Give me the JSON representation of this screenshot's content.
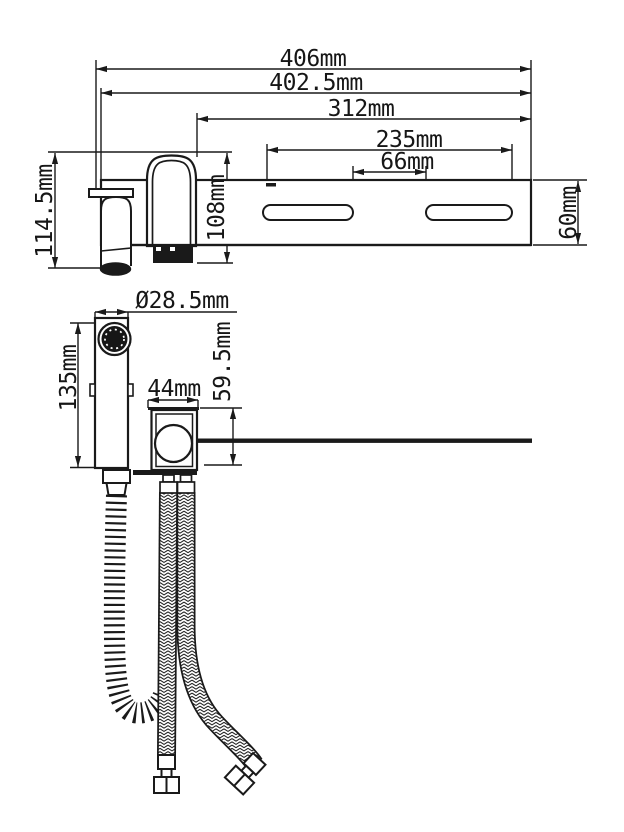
{
  "drawing": {
    "type": "technical-dimension-drawing",
    "subject": "wall-mounted faucet with shelf, hand sprayer and supply hoses",
    "colors": {
      "background": "#ffffff",
      "line": "#1a1a1a"
    }
  },
  "dimensions": {
    "overall_width": "406mm",
    "plate_width": "402.5mm",
    "body_to_end": "312mm",
    "slots_span": "235mm",
    "slots_gap": "66mm",
    "left_height": "114.5mm",
    "handle_height": "108mm",
    "shelf_depth": "60mm",
    "sprayer_diameter": "Ø28.5mm",
    "sprayer_length": "135mm",
    "valve_width": "44mm",
    "valve_height": "59.5mm"
  }
}
